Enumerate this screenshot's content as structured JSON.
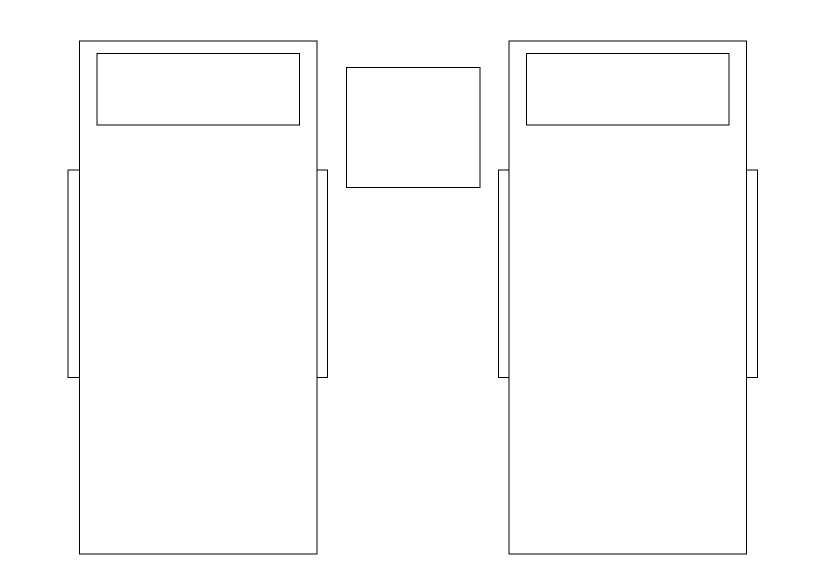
{
  "canvas": {
    "width": 826,
    "height": 583,
    "background_color": "#ffffff",
    "line_color": "#000000",
    "line_width": 1
  },
  "shapes": [
    {
      "name": "left-bed-frame",
      "type": "rect",
      "x": 79.5,
      "y": 41,
      "w": 237.5,
      "h": 513
    },
    {
      "name": "left-bed-pillow",
      "type": "rect",
      "x": 97,
      "y": 53.5,
      "w": 202.5,
      "h": 71.5
    },
    {
      "name": "left-bed-left-rail",
      "type": "rect",
      "x": 68,
      "y": 170,
      "w": 11.5,
      "h": 207.5
    },
    {
      "name": "left-bed-right-rail",
      "type": "rect",
      "x": 317,
      "y": 170,
      "w": 10.5,
      "h": 207.5
    },
    {
      "name": "nightstand",
      "type": "rect",
      "x": 346.5,
      "y": 67.5,
      "w": 133.5,
      "h": 120
    },
    {
      "name": "right-bed-frame",
      "type": "rect",
      "x": 509,
      "y": 41,
      "w": 237.5,
      "h": 513
    },
    {
      "name": "right-bed-pillow",
      "type": "rect",
      "x": 526.5,
      "y": 53.5,
      "w": 202.5,
      "h": 71.5
    },
    {
      "name": "right-bed-left-rail",
      "type": "rect",
      "x": 498.5,
      "y": 170,
      "w": 10.5,
      "h": 207.5
    },
    {
      "name": "right-bed-right-rail",
      "type": "rect",
      "x": 746.5,
      "y": 170,
      "w": 11,
      "h": 207.5
    }
  ]
}
